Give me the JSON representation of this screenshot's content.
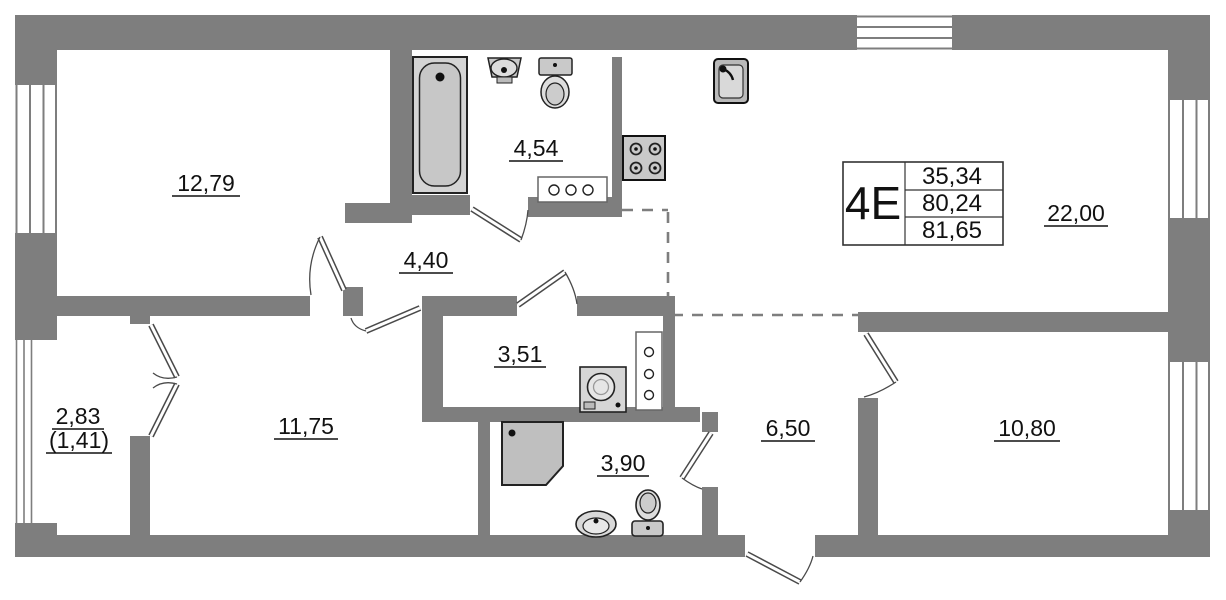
{
  "plan_type": "apartment-floor-plan",
  "colors": {
    "wall": "#7e7e7e",
    "outline": "#222222",
    "fixture_fill": "#d6d6d6",
    "text": "#111111"
  },
  "stamp": {
    "unit": "4E",
    "row1": "35,34",
    "row2": "80,24",
    "row3": "81,65"
  },
  "rooms": {
    "room1": {
      "label": "12,79"
    },
    "bathroom": {
      "label": "4,54"
    },
    "hall": {
      "label": "4,40"
    },
    "living": {
      "label": "22,00"
    },
    "laundry": {
      "label": "3,51"
    },
    "balcony": {
      "label": "2,83",
      "secondary": "(1,41)"
    },
    "room2": {
      "label": "11,75"
    },
    "wc": {
      "label": "3,90"
    },
    "entry": {
      "label": "6,50"
    },
    "room3": {
      "label": "10,80"
    }
  },
  "icons": {
    "bathtub": "bathtub-icon",
    "wall_basin": "basin-icon",
    "toilet_top": "toilet-icon",
    "bath_counter": "counter-icon",
    "kitchen_sink": "kitchen-sink-icon",
    "stove": "stove-icon",
    "washing_machine": "washing-machine-icon",
    "tall_cabinet": "cabinet-icon",
    "shower": "shower-icon",
    "wc_basin": "basin-icon",
    "wc_toilet": "toilet-icon"
  }
}
